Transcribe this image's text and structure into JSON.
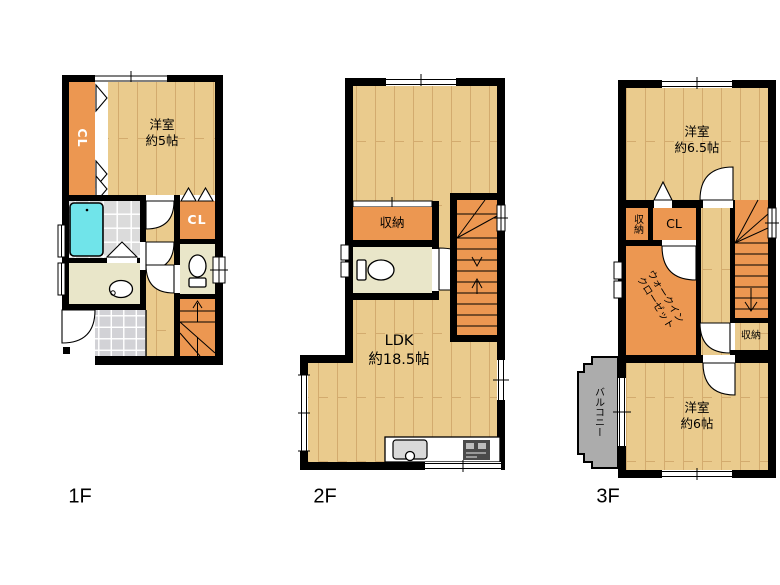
{
  "colors": {
    "wall": "#000000",
    "wood": "#eacb8d",
    "woodline": "#d3ab6e",
    "orange": "#ec9751",
    "cream": "#e9e6c9",
    "tile": "#dbdbdb",
    "genkan": "#d2d2d6",
    "bathtub": "#70e4ea",
    "balcony": "#acacac"
  },
  "floor1": {
    "label": "1F",
    "closet1": "CL",
    "bedroom": {
      "name": "洋室",
      "size": "約5帖"
    },
    "closet2": "CL"
  },
  "floor2": {
    "label": "2F",
    "storage": "収納",
    "ldk": {
      "name": "LDK",
      "size": "約18.5帖"
    }
  },
  "floor3": {
    "label": "3F",
    "bedroom1": {
      "name": "洋室",
      "size": "約6.5帖"
    },
    "storage1": "収納",
    "closet": "CL",
    "wic": {
      "line1": "ウォークイン",
      "line2": "クローゼット"
    },
    "storage2": "収納",
    "balcony": "バルコニー",
    "bedroom2": {
      "name": "洋室",
      "size": "約6帖"
    }
  }
}
